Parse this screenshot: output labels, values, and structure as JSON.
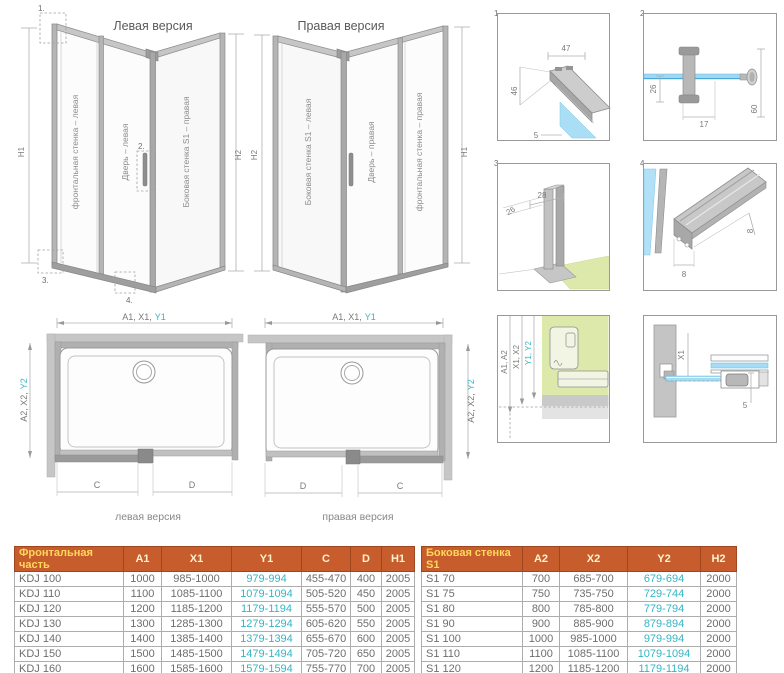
{
  "colors": {
    "teal": "#35b5c4",
    "header_bg": "#c75d2c",
    "header_label_yellow": "#ffd85c",
    "glass_blue": "#a8ddf4",
    "floor_green": "#dde9ab",
    "profile_grey": "#b4b4b4"
  },
  "iso_left": {
    "title": "Левая версия",
    "panel_front": "фронтальная стенка – левая",
    "panel_door": "Дверь – левая",
    "panel_side": "Боковая стенка S1 – правая",
    "dim_left": "H1",
    "dim_right": "H2",
    "callout_1": "1.",
    "callout_2": "2.",
    "callout_3": "3.",
    "callout_4": "4."
  },
  "iso_right": {
    "title": "Правая версия",
    "panel_side": "Боковая стенка S1 – левая",
    "panel_door": "Дверь – правая",
    "panel_front": "фронтальная стенка – правая",
    "dim_left": "H2",
    "dim_right": "H1"
  },
  "details": {
    "d1": {
      "num": "1.",
      "dim_top": "47",
      "dim_left": "46",
      "dim_bottom": "5"
    },
    "d2": {
      "num": "2.",
      "dim_left": "26",
      "dim_bottom": "17",
      "dim_right": "60"
    },
    "d3": {
      "num": "3.",
      "dim_top": "28",
      "dim_diag": "26"
    },
    "d4": {
      "num": "4.",
      "dim_right": "8",
      "dim_bottom": "8"
    },
    "d5": {
      "label_a": "A1, A2",
      "label_x": "X1, X2",
      "label_y": "Y1, Y2"
    },
    "d6": {
      "label_x": "X1",
      "dim": "5"
    }
  },
  "top_view_left": {
    "dim_top_prefix": "A1, X1,",
    "dim_top_teal": "Y1",
    "dim_side_prefix": "A2, X2,",
    "dim_side_teal": "Y2",
    "dim_c": "C",
    "dim_d": "D",
    "caption": "левая версия"
  },
  "top_view_right": {
    "dim_top_prefix": "A1, X1,",
    "dim_top_teal": "Y1",
    "dim_side_prefix": "A2, X2,",
    "dim_side_teal": "Y2",
    "dim_c": "C",
    "dim_d": "D",
    "caption": "правая версия"
  },
  "tables": {
    "front": {
      "header": [
        "Фронтальная часть",
        "A1",
        "X1",
        "Y1",
        "C",
        "D",
        "H1"
      ],
      "teal_col": 3,
      "rows": [
        [
          "KDJ 100",
          "1000",
          "985-1000",
          "979-994",
          "455-470",
          "400",
          "2005"
        ],
        [
          "KDJ 110",
          "1100",
          "1085-1100",
          "1079-1094",
          "505-520",
          "450",
          "2005"
        ],
        [
          "KDJ 120",
          "1200",
          "1185-1200",
          "1179-1194",
          "555-570",
          "500",
          "2005"
        ],
        [
          "KDJ 130",
          "1300",
          "1285-1300",
          "1279-1294",
          "605-620",
          "550",
          "2005"
        ],
        [
          "KDJ 140",
          "1400",
          "1385-1400",
          "1379-1394",
          "655-670",
          "600",
          "2005"
        ],
        [
          "KDJ 150",
          "1500",
          "1485-1500",
          "1479-1494",
          "705-720",
          "650",
          "2005"
        ],
        [
          "KDJ 160",
          "1600",
          "1585-1600",
          "1579-1594",
          "755-770",
          "700",
          "2005"
        ]
      ]
    },
    "side": {
      "header": [
        "Боковая стенка S1",
        "A2",
        "X2",
        "Y2",
        "H2"
      ],
      "teal_col": 3,
      "rows": [
        [
          "S1 70",
          "700",
          "685-700",
          "679-694",
          "2000"
        ],
        [
          "S1 75",
          "750",
          "735-750",
          "729-744",
          "2000"
        ],
        [
          "S1 80",
          "800",
          "785-800",
          "779-794",
          "2000"
        ],
        [
          "S1 90",
          "900",
          "885-900",
          "879-894",
          "2000"
        ],
        [
          "S1 100",
          "1000",
          "985-1000",
          "979-994",
          "2000"
        ],
        [
          "S1 110",
          "1100",
          "1085-1100",
          "1079-1094",
          "2000"
        ],
        [
          "S1 120",
          "1200",
          "1185-1200",
          "1179-1194",
          "2000"
        ]
      ]
    }
  }
}
